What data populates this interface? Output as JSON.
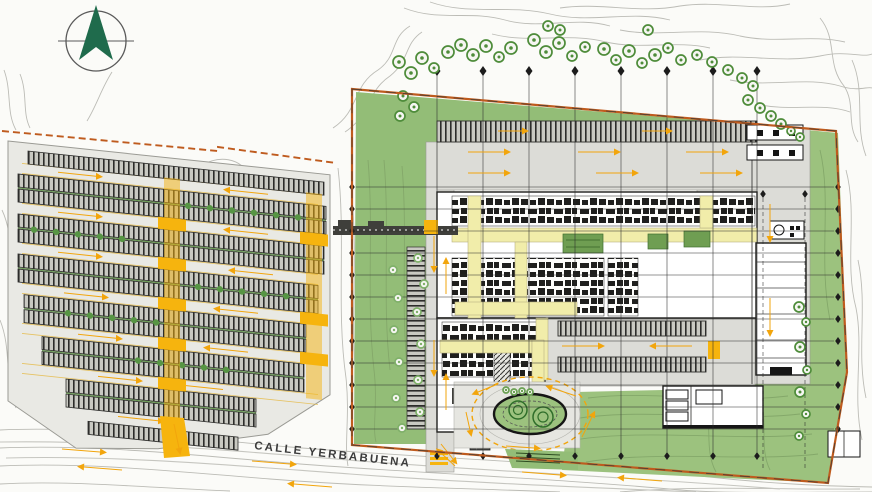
{
  "street": {
    "label": "CALLE YERBABUENA"
  },
  "compass": {
    "meaning": "north"
  },
  "colors": {
    "boundary_orange": "#bf5b1e",
    "arrow_orange": "#f2a50c",
    "road_yellow": "#f6b40e",
    "corridor_yellow": "#f1edaa",
    "lawn_green": "#9cc27e",
    "strip_green": "#93bd77",
    "courtyard_green": "#6f9e52",
    "tree_green": "#4e8c3a",
    "tree_light_green": "#7fb069",
    "north_green": "#1f6b4c",
    "road_gray": "#dcdcd7",
    "contour_gray": "#bcbcb6",
    "ink": "#1d1d1b"
  },
  "grid": {
    "verticals": {
      "xs": [
        437,
        483,
        529,
        575,
        621,
        667,
        713,
        757
      ],
      "y1": 75,
      "y2": 452
    },
    "horizontals": {
      "ys": [
        187,
        209,
        231,
        253,
        275,
        297,
        319,
        341,
        363,
        385,
        407,
        429
      ],
      "x1": 356,
      "x2": 834
    },
    "right_verticals": {
      "xs": [
        763,
        805
      ],
      "y1": 198,
      "y2": 468
    }
  },
  "trees": {
    "groups": [
      {
        "cls": "tree-dark",
        "color": "#4e8c3a",
        "items": [
          [
            399,
            62,
            6
          ],
          [
            411,
            73,
            6
          ],
          [
            422,
            58,
            6
          ],
          [
            434,
            68,
            5
          ],
          [
            448,
            52,
            6
          ],
          [
            403,
            96,
            5
          ],
          [
            414,
            107,
            5
          ],
          [
            400,
            116,
            5
          ],
          [
            461,
            45,
            6
          ],
          [
            473,
            55,
            6
          ],
          [
            486,
            46,
            6
          ],
          [
            499,
            57,
            5
          ],
          [
            511,
            48,
            6
          ],
          [
            534,
            40,
            6
          ],
          [
            546,
            52,
            6
          ],
          [
            559,
            43,
            6
          ],
          [
            572,
            56,
            5
          ],
          [
            585,
            47,
            5
          ],
          [
            560,
            30,
            5
          ],
          [
            548,
            26,
            5
          ],
          [
            604,
            49,
            6
          ],
          [
            616,
            60,
            5
          ],
          [
            629,
            51,
            6
          ],
          [
            642,
            63,
            5
          ],
          [
            655,
            55,
            6
          ],
          [
            668,
            48,
            5
          ],
          [
            681,
            60,
            5
          ],
          [
            697,
            55,
            5
          ],
          [
            648,
            30,
            5
          ],
          [
            712,
            62,
            5
          ],
          [
            728,
            70,
            5
          ],
          [
            742,
            78,
            5
          ],
          [
            753,
            86,
            5
          ],
          [
            748,
            100,
            5
          ],
          [
            760,
            108,
            5
          ],
          [
            771,
            116,
            5
          ],
          [
            781,
            124,
            5
          ],
          [
            791,
            131,
            4
          ],
          [
            800,
            137,
            4
          ]
        ]
      },
      {
        "cls": "tree-dark",
        "color": "#4e8c3a",
        "items": [
          [
            799,
            307,
            5
          ],
          [
            806,
            322,
            4
          ],
          [
            800,
            347,
            5
          ],
          [
            807,
            370,
            4
          ],
          [
            800,
            392,
            5
          ],
          [
            806,
            414,
            4
          ],
          [
            799,
            436,
            4
          ]
        ]
      },
      {
        "cls": "tree-light",
        "color": "#7fb069",
        "items": [
          [
            418,
            258,
            4
          ],
          [
            393,
            270,
            4
          ],
          [
            424,
            284,
            4
          ],
          [
            398,
            298,
            4
          ],
          [
            417,
            312,
            4
          ],
          [
            394,
            330,
            4
          ],
          [
            421,
            344,
            4
          ],
          [
            399,
            362,
            4
          ],
          [
            418,
            380,
            4
          ],
          [
            396,
            398,
            4
          ],
          [
            420,
            412,
            4
          ],
          [
            402,
            428,
            4
          ]
        ]
      },
      {
        "cls": "tree-light",
        "color": "#6aa052",
        "items": [
          [
            506,
            390,
            3
          ],
          [
            514,
            392,
            3
          ],
          [
            522,
            391,
            3
          ],
          [
            530,
            392,
            3
          ]
        ]
      }
    ]
  },
  "parking": {
    "rows": [
      {
        "x": 10,
        "y": 0,
        "w": 296,
        "d": false
      },
      {
        "x": 0,
        "y": 24,
        "w": 308,
        "d": true
      },
      {
        "x": 0,
        "y": 64,
        "w": 306,
        "d": true
      },
      {
        "x": 0,
        "y": 104,
        "w": 300,
        "d": true
      },
      {
        "x": 6,
        "y": 144,
        "w": 282,
        "d": true
      },
      {
        "x": 24,
        "y": 184,
        "w": 262,
        "d": true
      },
      {
        "x": 48,
        "y": 224,
        "w": 190,
        "d": true
      },
      {
        "x": 70,
        "y": 264,
        "w": 150,
        "d": false
      }
    ],
    "tree_rows": [
      {
        "y": 38,
        "xs": [
          170,
          192,
          214,
          236,
          258,
          280
        ]
      },
      {
        "y": 78,
        "xs": [
          16,
          38,
          60,
          82,
          104
        ]
      },
      {
        "y": 118,
        "xs": [
          180,
          202,
          224,
          246,
          268
        ]
      },
      {
        "y": 158,
        "xs": [
          50,
          72,
          94,
          116,
          138
        ]
      },
      {
        "y": 198,
        "xs": [
          120,
          142,
          164,
          186,
          208
        ]
      }
    ],
    "lanes": [
      18,
      58,
      98,
      138,
      178,
      218
    ],
    "arrows": [
      [
        40,
        18,
        78,
        18
      ],
      [
        250,
        18,
        212,
        18
      ],
      [
        40,
        58,
        78,
        58
      ],
      [
        250,
        58,
        212,
        58
      ],
      [
        40,
        98,
        78,
        98
      ],
      [
        255,
        98,
        217,
        98
      ],
      [
        46,
        138,
        84,
        138
      ],
      [
        240,
        138,
        202,
        138
      ],
      [
        60,
        178,
        98,
        178
      ],
      [
        230,
        178,
        192,
        178
      ],
      [
        80,
        218,
        118,
        218
      ],
      [
        205,
        218,
        167,
        218
      ],
      [
        100,
        256,
        140,
        256
      ]
    ]
  },
  "arrows": {
    "global": [
      [
        62,
        449,
        100,
        452
      ],
      [
        252,
        461,
        290,
        464
      ],
      [
        522,
        472,
        560,
        475
      ],
      [
        662,
        481,
        624,
        478
      ],
      [
        332,
        487,
        294,
        484
      ],
      [
        122,
        470,
        84,
        467
      ],
      [
        468,
        152,
        504,
        152
      ],
      [
        578,
        152,
        614,
        152
      ],
      [
        686,
        152,
        722,
        152
      ],
      [
        468,
        173,
        504,
        173
      ],
      [
        596,
        173,
        632,
        173
      ],
      [
        700,
        173,
        736,
        173
      ],
      [
        498,
        131,
        522,
        131
      ],
      [
        642,
        131,
        666,
        131
      ],
      [
        434,
        236,
        434,
        266
      ],
      [
        446,
        294,
        446,
        264
      ],
      [
        434,
        340,
        434,
        370
      ],
      [
        446,
        410,
        446,
        380
      ],
      [
        441,
        444,
        453,
        459
      ],
      [
        770,
        204,
        770,
        236
      ],
      [
        770,
        298,
        770,
        330
      ],
      [
        562,
        346,
        598,
        346
      ],
      [
        692,
        346,
        656,
        346
      ],
      [
        498,
        384,
        478,
        392
      ],
      [
        466,
        412,
        470,
        430
      ],
      [
        506,
        446,
        534,
        448
      ],
      [
        582,
        437,
        592,
        417
      ],
      [
        576,
        396,
        552,
        388
      ],
      [
        455,
        466,
        441,
        453
      ],
      [
        174,
        424,
        179,
        448
      ]
    ]
  }
}
